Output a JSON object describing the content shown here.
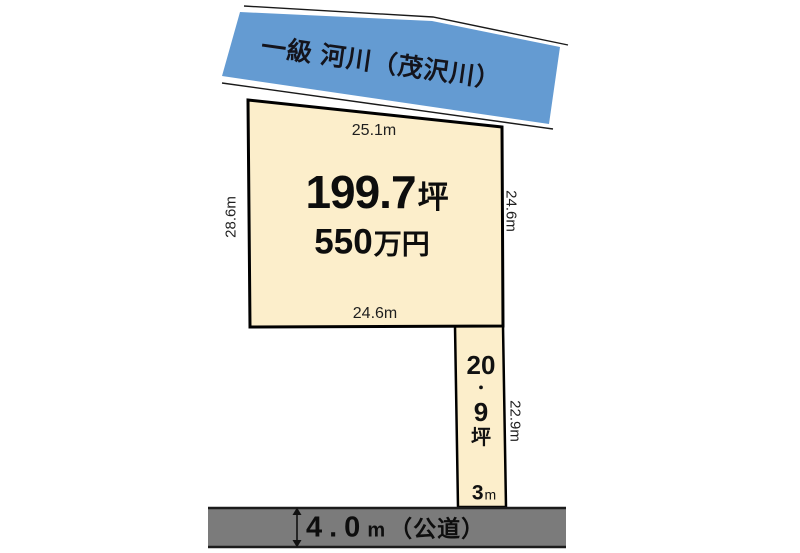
{
  "colors": {
    "river_fill": "#649BD2",
    "plot_fill": "#FCEECB",
    "road_fill": "#7B7B7B"
  },
  "river": {
    "label": "一級 河川（茂沢川）"
  },
  "main_plot": {
    "area_value": "199.7",
    "area_unit": "坪",
    "price_value": "550",
    "price_unit": "万円",
    "dim_top": "25.1m",
    "dim_left": "28.6m",
    "dim_right": "24.6m",
    "dim_bottom": "24.6m"
  },
  "strip_plot": {
    "area_chars": [
      "20",
      "・",
      "9",
      "坪"
    ],
    "dim_right": "22.9m",
    "frontage_value": "3",
    "frontage_unit": "m"
  },
  "road": {
    "width_value": "4.0",
    "width_unit": "m",
    "type_label": "（公道）"
  }
}
